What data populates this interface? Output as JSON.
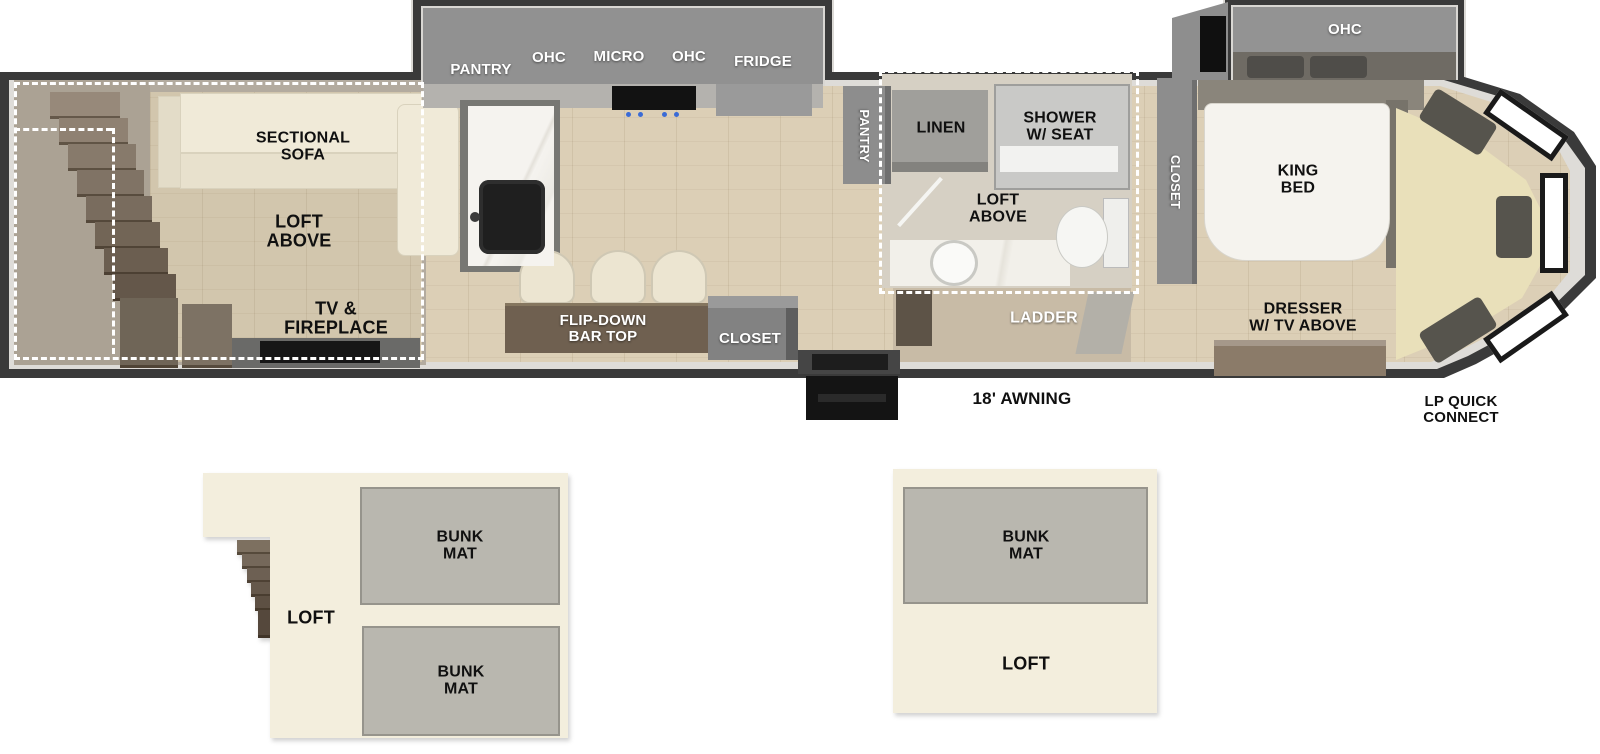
{
  "plan": {
    "living": {
      "sofa_label": "SECTIONAL\nSOFA",
      "loft_label": "LOFT\nABOVE",
      "tv_label": "TV &\nFIREPLACE"
    },
    "kitchen": {
      "pantry_label": "PANTRY",
      "ohc_left_label": "OHC",
      "micro_label": "MICRO",
      "ohc_right_label": "OHC",
      "fridge_label": "FRIDGE",
      "pantry_vertical_label": "PANTRY",
      "bar_label": "FLIP-DOWN\nBAR TOP",
      "closet_label": "CLOSET"
    },
    "bath": {
      "linen_label": "LINEN",
      "shower_label": "SHOWER\nW/ SEAT",
      "loft_label": "LOFT\nABOVE",
      "ladder_label": "LADDER"
    },
    "bedroom": {
      "closet_label": "CLOSET",
      "ohc_label": "OHC",
      "bed_label": "KING\nBED",
      "dresser_label": "DRESSER\nW/ TV ABOVE"
    },
    "exterior": {
      "awning_label": "18' AWNING",
      "lp_label": "LP QUICK\nCONNECT"
    }
  },
  "lofts": {
    "left": {
      "label": "LOFT",
      "bunk_top_label": "BUNK\nMAT",
      "bunk_bottom_label": "BUNK\nMAT"
    },
    "right": {
      "label": "LOFT",
      "bunk_label": "BUNK\nMAT"
    }
  },
  "colors": {
    "wall": "#3a3a3a",
    "wall_liner": "#dedcd8",
    "floor_wood": "#dccfb6",
    "slide_floor": "#b3ab9f",
    "cabinet_gray": "#8d8d8d",
    "sofa_cream": "#f0ead8",
    "loft_panel_cream": "#f3eedd",
    "bunk_gray": "#b9b7af",
    "bar_brown": "#6f6050",
    "nose_platform": "#e9e0ba"
  }
}
